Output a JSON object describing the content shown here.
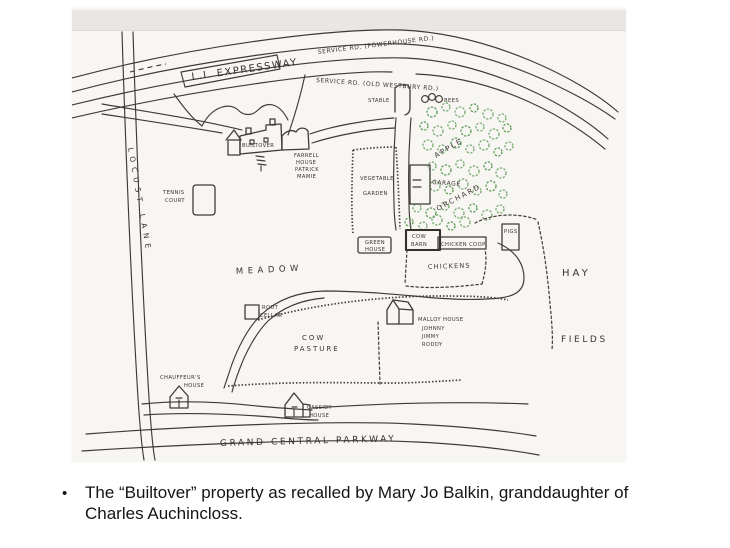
{
  "slide": {
    "caption_bullet": "•",
    "caption_line1": "The “Builtover” property as recalled by Mary Jo Balkin, granddaughter of",
    "caption_line2": "Charles Auchincloss."
  },
  "map": {
    "colors": {
      "ink": "#403a35",
      "tree_green": "#79ab72",
      "paper": "#f7f6f3",
      "scan_band": "#e9e7e3"
    },
    "roads": {
      "service_rd_top": "SERVICE RD. (POWERHOUSE RD.)",
      "li_expressway": "L.I. EXPRESSWAY",
      "service_rd_lower": "SERVICE RD. (OLD WESTBURY RD.)",
      "locust_lane": "LOCUST  LANE",
      "grand_central_parkway": "GRAND  CENTRAL  PARKWAY"
    },
    "places": {
      "stable": "STABLE",
      "bees": "BEES",
      "apple": "APPLE",
      "orchard": "ORCHARD",
      "garage": "GARAGE",
      "builtover": "BUILTOVER",
      "farrell_1": "FARRELL",
      "farrell_2": "HOUSE",
      "farrell_3": "PATRICK",
      "farrell_4": "MAMIE",
      "tennis_1": "TENNIS",
      "tennis_2": "COURT",
      "vegetable": "VEGETABLE",
      "garden": "GARDEN",
      "greenhouse_1": "GREEN",
      "greenhouse_2": "HOUSE",
      "cow_barn_1": "COW",
      "cow_barn_2": "BARN",
      "chicken_coop": "CHICKEN COOP",
      "pigs": "PIGS",
      "chickens": "CHICKENS",
      "hay": "HAY",
      "fields": "FIELDS",
      "meadow": "MEADOW",
      "root_cellar_1": "ROUT",
      "root_cellar_2": "CELLAR",
      "cow_pasture_1": "COW",
      "cow_pasture_2": "PASTURE",
      "malloy_1": "MALLOY HOUSE",
      "malloy_2": "JOHNNY",
      "malloy_3": "JIMMY",
      "malloy_4": "RODDY",
      "chauffeur_1": "CHAUFFEUR'S",
      "chauffeur_2": "HOUSE",
      "cassidy_1": "CASSIDY",
      "cassidy_2": "HOUSE"
    },
    "orchard_trees": [
      [
        360,
        104,
        5
      ],
      [
        374,
        99,
        4
      ],
      [
        388,
        104,
        5
      ],
      [
        402,
        100,
        4
      ],
      [
        416,
        106,
        5
      ],
      [
        430,
        110,
        4
      ],
      [
        352,
        118,
        4
      ],
      [
        366,
        123,
        5
      ],
      [
        380,
        117,
        4
      ],
      [
        394,
        123,
        5
      ],
      [
        408,
        119,
        4
      ],
      [
        422,
        126,
        5
      ],
      [
        435,
        120,
        4
      ],
      [
        356,
        137,
        5
      ],
      [
        370,
        141,
        4
      ],
      [
        384,
        135,
        5
      ],
      [
        398,
        141,
        4
      ],
      [
        412,
        137,
        5
      ],
      [
        426,
        144,
        4
      ],
      [
        437,
        138,
        4
      ],
      [
        360,
        158,
        4
      ],
      [
        374,
        162,
        5
      ],
      [
        388,
        156,
        4
      ],
      [
        402,
        163,
        5
      ],
      [
        416,
        158,
        4
      ],
      [
        429,
        165,
        5
      ],
      [
        363,
        178,
        5
      ],
      [
        377,
        182,
        4
      ],
      [
        391,
        176,
        5
      ],
      [
        405,
        183,
        4
      ],
      [
        419,
        178,
        5
      ],
      [
        431,
        186,
        4
      ],
      [
        345,
        200,
        4
      ],
      [
        359,
        205,
        5
      ],
      [
        373,
        198,
        4
      ],
      [
        387,
        205,
        5
      ],
      [
        401,
        200,
        4
      ],
      [
        415,
        207,
        5
      ],
      [
        428,
        201,
        4
      ],
      [
        337,
        214,
        4
      ],
      [
        351,
        218,
        4
      ],
      [
        365,
        212,
        5
      ],
      [
        379,
        218,
        4
      ],
      [
        393,
        214,
        5
      ]
    ]
  }
}
